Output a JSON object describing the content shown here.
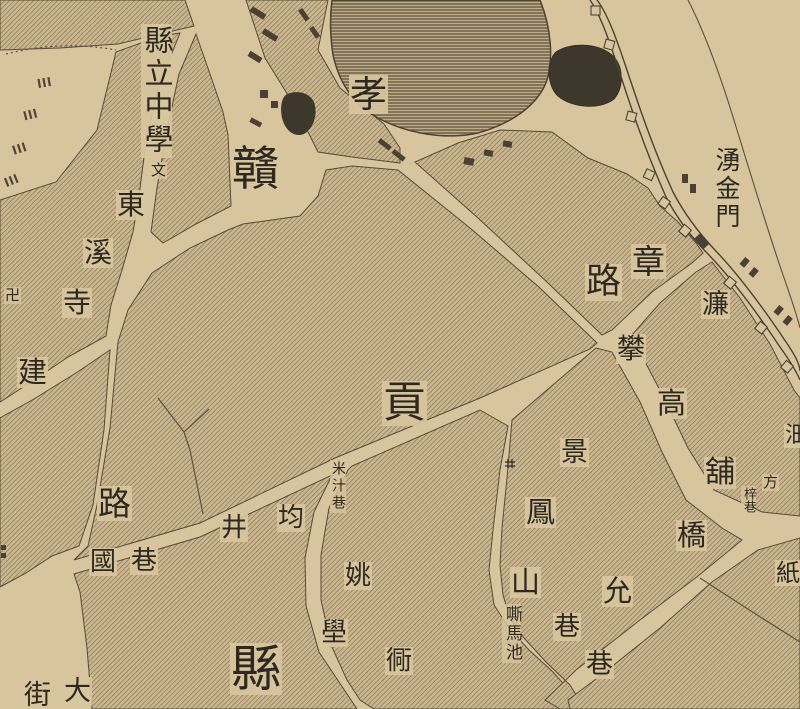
{
  "map": {
    "type": "historical-chinese-city-map-detail",
    "colors": {
      "paper": "#d9c59d",
      "block_base": "#cbb68e",
      "hatch_line": "#6e6450",
      "ink": "#2e2920",
      "water_dark": "#3e382c",
      "wall_line": "#4a4336"
    },
    "labels": [
      {
        "text": "縣立中學",
        "x": 141,
        "y": 24,
        "size": 29,
        "vertical": true
      },
      {
        "text": "文",
        "x": 150,
        "y": 162,
        "size": 15
      },
      {
        "text": "東",
        "x": 116,
        "y": 190,
        "size": 28
      },
      {
        "text": "溪",
        "x": 83,
        "y": 238,
        "size": 28
      },
      {
        "text": "寺",
        "x": 62,
        "y": 288,
        "size": 28
      },
      {
        "text": "卍",
        "x": 4,
        "y": 287,
        "size": 15
      },
      {
        "text": "贛",
        "x": 231,
        "y": 145,
        "size": 47
      },
      {
        "text": "孝",
        "x": 349,
        "y": 75,
        "size": 37
      },
      {
        "text": "湧金門",
        "x": 713,
        "y": 146,
        "size": 25,
        "vertical": true
      },
      {
        "text": "章",
        "x": 631,
        "y": 244,
        "size": 33
      },
      {
        "text": "路",
        "x": 585,
        "y": 264,
        "size": 35
      },
      {
        "text": "貢",
        "x": 382,
        "y": 381,
        "size": 43
      },
      {
        "text": "濂",
        "x": 701,
        "y": 290,
        "size": 27
      },
      {
        "text": "攀",
        "x": 616,
        "y": 334,
        "size": 28
      },
      {
        "text": "高",
        "x": 656,
        "y": 388,
        "size": 29
      },
      {
        "text": "舖",
        "x": 704,
        "y": 457,
        "size": 30
      },
      {
        "text": "方",
        "x": 762,
        "y": 474,
        "size": 15
      },
      {
        "text": "梓巷",
        "x": 741,
        "y": 486,
        "size": 13,
        "vertical": true
      },
      {
        "text": "沺",
        "x": 784,
        "y": 424,
        "size": 22
      },
      {
        "text": "紙",
        "x": 775,
        "y": 560,
        "size": 24
      },
      {
        "text": "橋",
        "x": 676,
        "y": 520,
        "size": 29
      },
      {
        "text": "允",
        "x": 602,
        "y": 576,
        "size": 29
      },
      {
        "text": "巷",
        "x": 585,
        "y": 650,
        "size": 27
      },
      {
        "text": "景",
        "x": 560,
        "y": 438,
        "size": 27
      },
      {
        "text": "鳳",
        "x": 525,
        "y": 497,
        "size": 29
      },
      {
        "text": "山",
        "x": 510,
        "y": 567,
        "size": 29
      },
      {
        "text": "嘶馬池",
        "x": 502,
        "y": 604,
        "size": 17,
        "vertical": true
      },
      {
        "text": "巷",
        "x": 553,
        "y": 613,
        "size": 26
      },
      {
        "text": "路",
        "x": 97,
        "y": 486,
        "size": 33
      },
      {
        "text": "建",
        "x": 17,
        "y": 357,
        "size": 29
      },
      {
        "text": "國",
        "x": 89,
        "y": 548,
        "size": 26
      },
      {
        "text": "巷",
        "x": 130,
        "y": 547,
        "size": 26
      },
      {
        "text": "井",
        "x": 220,
        "y": 514,
        "size": 26
      },
      {
        "text": "均",
        "x": 277,
        "y": 504,
        "size": 26
      },
      {
        "text": "米汁巷",
        "x": 330,
        "y": 460,
        "size": 14,
        "vertical": true
      },
      {
        "text": "姚",
        "x": 344,
        "y": 562,
        "size": 26
      },
      {
        "text": "壆",
        "x": 320,
        "y": 619,
        "size": 26
      },
      {
        "text": "衕",
        "x": 385,
        "y": 647,
        "size": 26
      },
      {
        "text": "縣",
        "x": 230,
        "y": 643,
        "size": 50
      },
      {
        "text": "大",
        "x": 63,
        "y": 677,
        "size": 27
      },
      {
        "text": "街",
        "x": 23,
        "y": 681,
        "size": 27
      }
    ],
    "symbols": [
      {
        "name": "school-symbol",
        "glyph": "文"
      },
      {
        "name": "swastika-temple-icon",
        "glyph": "卍"
      },
      {
        "name": "well-icon",
        "x": 506,
        "y": 460
      },
      {
        "name": "city-gate",
        "gloss_visible_label": "湧金門"
      }
    ],
    "features": [
      {
        "name": "large-pond",
        "type": "water-hatched"
      },
      {
        "name": "dark-pond",
        "type": "water-solid"
      },
      {
        "name": "city-wall",
        "type": "double-line-with-bastions"
      },
      {
        "name": "river-shore-line",
        "type": "line"
      },
      {
        "name": "hatched-city-blocks",
        "type": "area"
      },
      {
        "name": "compass-dial-ticks",
        "type": "arc-with-ticks"
      }
    ]
  }
}
